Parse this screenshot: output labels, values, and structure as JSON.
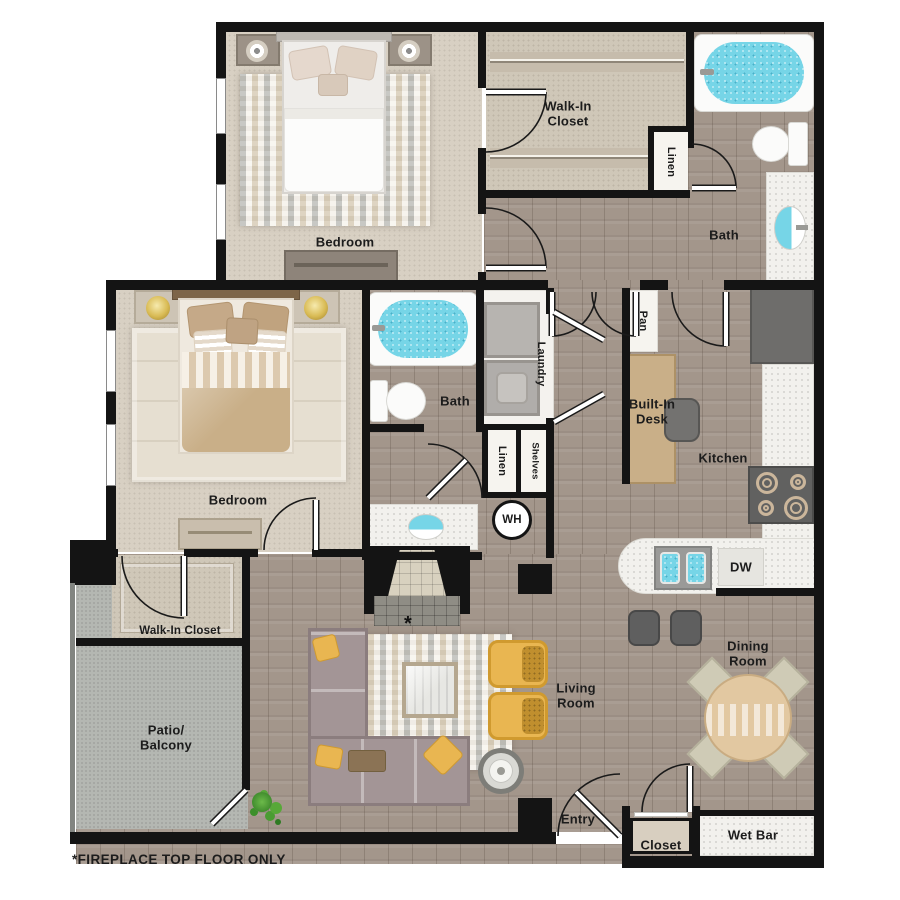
{
  "plan_title": "Two Bedroom Apartment Floor Plan",
  "footnote": "*FIREPLACE TOP FLOOR ONLY",
  "labels": {
    "bedroom_top": "Bedroom",
    "bedroom_left": "Bedroom",
    "walk_in_closet_top_line1": "Walk-In",
    "walk_in_closet_top_line2": "Closet",
    "walk_in_closet_left": "Walk-In Closet",
    "linen_top": "Linen",
    "linen_hall": "Linen",
    "shelves": "Shelves",
    "bath_top": "Bath",
    "bath_mid": "Bath",
    "laundry": "Laundry",
    "water_heater": "WH",
    "pantry": "Pan",
    "built_in_desk_line1": "Built-In",
    "built_in_desk_line2": "Desk",
    "kitchen": "Kitchen",
    "dishwasher": "DW",
    "dining_line1": "Dining",
    "dining_line2": "Room",
    "living_line1": "Living",
    "living_line2": "Room",
    "patio_line1": "Patio/",
    "patio_line2": "Balcony",
    "entry": "Entry",
    "closet": "Closet",
    "wet_bar": "Wet Bar",
    "fireplace_marker": "*"
  },
  "colors": {
    "wall": "#141414",
    "wood": "#a3968b",
    "carpet": "#d8d0c3",
    "carpet_dark": "#cfc7b8",
    "patio": "#b4b7b2",
    "counter": "#f2f1ed",
    "water": "#76d5e7",
    "chair_yellow": "#e9b651",
    "sofa": "#a39596",
    "table_wood": "#e2c8a1",
    "desk_wood": "#c9af88",
    "appliance_dark": "#6e6d6b",
    "rug_cream": "#e9e2d2",
    "label_text": "#1c1c1c"
  }
}
